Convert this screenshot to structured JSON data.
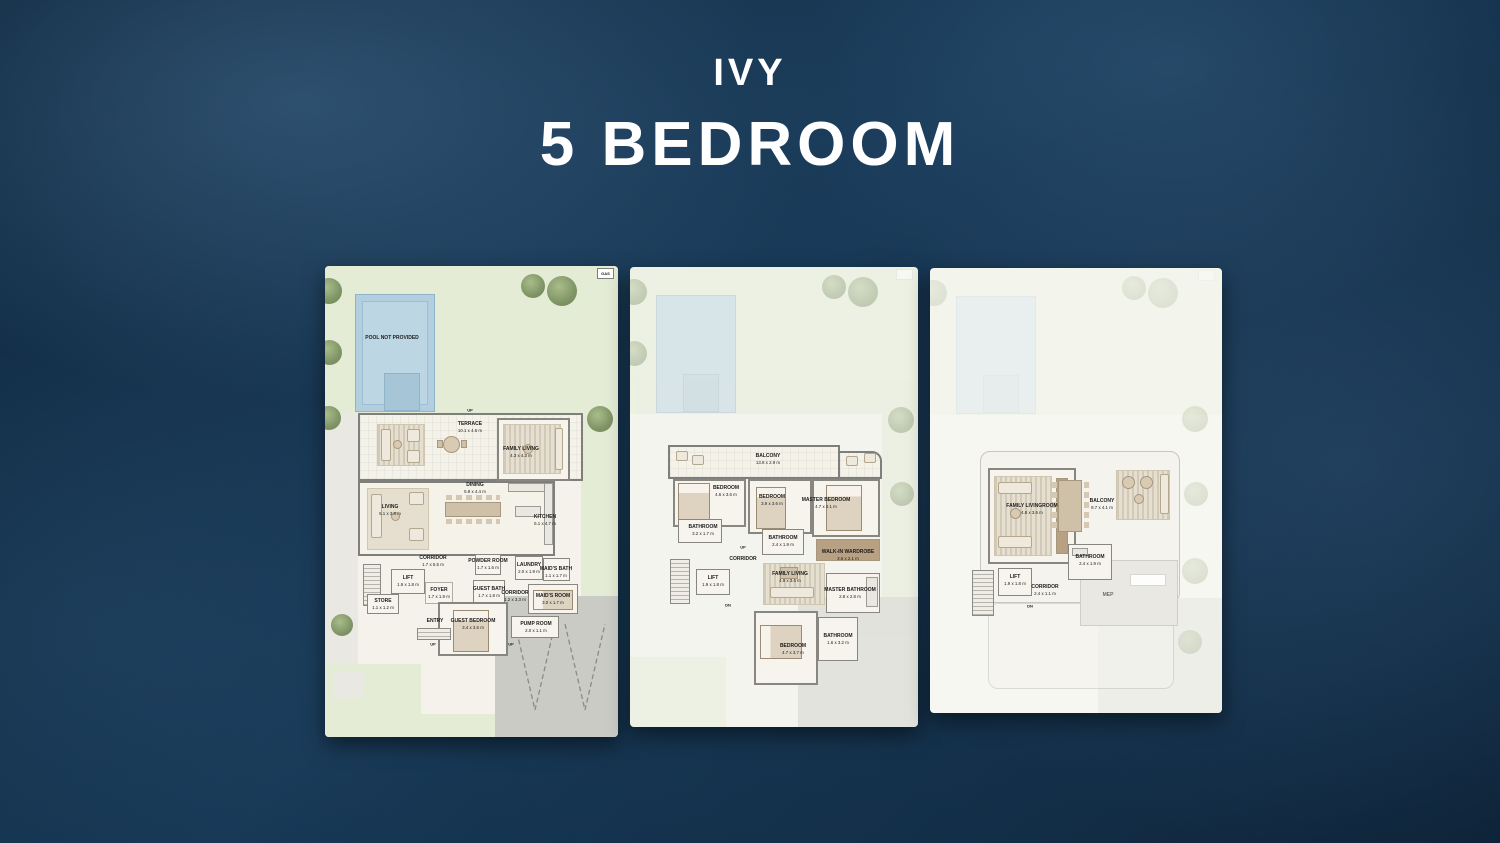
{
  "title": {
    "project": "IVY",
    "unit": "5 BEDROOM"
  },
  "colors": {
    "background_navy": "#0d2438",
    "title_text": "#ffffff",
    "garden_green": "#e4ecd6",
    "pool_blue": "#b3cfdf",
    "floor_cream": "#f4f2ea",
    "wall_gray": "#7e7e7a",
    "driveway_gray": "#cbcbc6"
  },
  "misc": {
    "up_label": "UP",
    "dn_label": "DN",
    "gas_label": "GAS"
  },
  "plans": {
    "ground": {
      "pool_label": "POOL NOT PROVIDED",
      "rooms": {
        "terrace": {
          "label": "TERRACE",
          "size": "10.1 x 4.5 m"
        },
        "family_living": {
          "label": "FAMILY LIVING",
          "size": "4.3 x 4.3 m"
        },
        "living": {
          "label": "LIVING",
          "size": "5.1 x 3.8 m"
        },
        "dining": {
          "label": "DINING",
          "size": "5.9 x 4.4 m"
        },
        "kitchen": {
          "label": "KITCHEN",
          "size": "5.1 x 4.7 m"
        },
        "corridor": {
          "label": "CORRIDOR",
          "size": "1.7 x 5.5 m"
        },
        "powder_room": {
          "label": "POWDER ROOM",
          "size": "1.7 x 1.6 m"
        },
        "laundry": {
          "label": "LAUNDRY",
          "size": "2.0 x 1.9 m"
        },
        "maids_bath": {
          "label": "MAID'S BATH",
          "size": "1.1 x 1.7 m"
        },
        "lift": {
          "label": "LIFT",
          "size": "1.9 x 1.8 m"
        },
        "foyer": {
          "label": "FOYER",
          "size": "1.7 x 1.9 m"
        },
        "store": {
          "label": "STORE",
          "size": "1.1 x 1.2 m"
        },
        "entry": {
          "label": "ENTRY",
          "size": ""
        },
        "guest_bath": {
          "label": "GUEST BATH",
          "size": "1.7 x 1.8 m"
        },
        "guest_bedroom": {
          "label": "GUEST BEDROOM",
          "size": "3.4 x 3.6 m"
        },
        "corridor2": {
          "label": "CORRIDOR",
          "size": "1.2 x 3.3 m"
        },
        "maids_room": {
          "label": "MAID'S ROOM",
          "size": "3.0 x 1.7 m"
        },
        "pump_room": {
          "label": "PUMP ROOM",
          "size": "2.0 x 1.1 m"
        }
      }
    },
    "first": {
      "rooms": {
        "balcony": {
          "label": "BALCONY",
          "size": "13.8 x 2.9 m"
        },
        "bedroom2": {
          "label": "BEDROOM",
          "size": "4.6 x 3.6 m"
        },
        "bedroom3": {
          "label": "BEDROOM",
          "size": "3.9 x 3.6 m"
        },
        "master_bedroom": {
          "label": "MASTER BEDROOM",
          "size": "4.7 x 4.1 m"
        },
        "bathroom2": {
          "label": "BATHROOM",
          "size": "3.2 x 1.7 m"
        },
        "bathroom3": {
          "label": "BATHROOM",
          "size": "2.4 x 1.9 m"
        },
        "walkin_wardrobe": {
          "label": "WALK-IN WARDROBE",
          "size": "3.6 x 2.1 m"
        },
        "corridor": {
          "label": "CORRIDOR",
          "size": ""
        },
        "lift": {
          "label": "LIFT",
          "size": "1.9 x 1.8 m"
        },
        "family_living": {
          "label": "FAMILY LIVING",
          "size": "4.9 x 3.6 m"
        },
        "master_bathroom": {
          "label": "MASTER BATHROOM",
          "size": "2.8 x 2.8 m"
        },
        "bedroom4": {
          "label": "BEDROOM",
          "size": "4.7 x 3.7 m"
        },
        "bathroom4": {
          "label": "BATHROOM",
          "size": "1.6 x 3.2 m"
        }
      }
    },
    "roof": {
      "rooms": {
        "family_livingroom": {
          "label": "FAMILY LIVINGROOM",
          "size": "4.8 x 3.6 m"
        },
        "balcony": {
          "label": "BALCONY",
          "size": "8.7 x 4.1 m"
        },
        "bathroom": {
          "label": "BATHROOM",
          "size": "2.4 x 1.9 m"
        },
        "lift": {
          "label": "LIFT",
          "size": "1.9 x 1.8 m"
        },
        "corridor": {
          "label": "CORRIDOR",
          "size": "2.4 x 1.1 m"
        },
        "mep": {
          "label": "MEP",
          "size": ""
        }
      }
    }
  }
}
